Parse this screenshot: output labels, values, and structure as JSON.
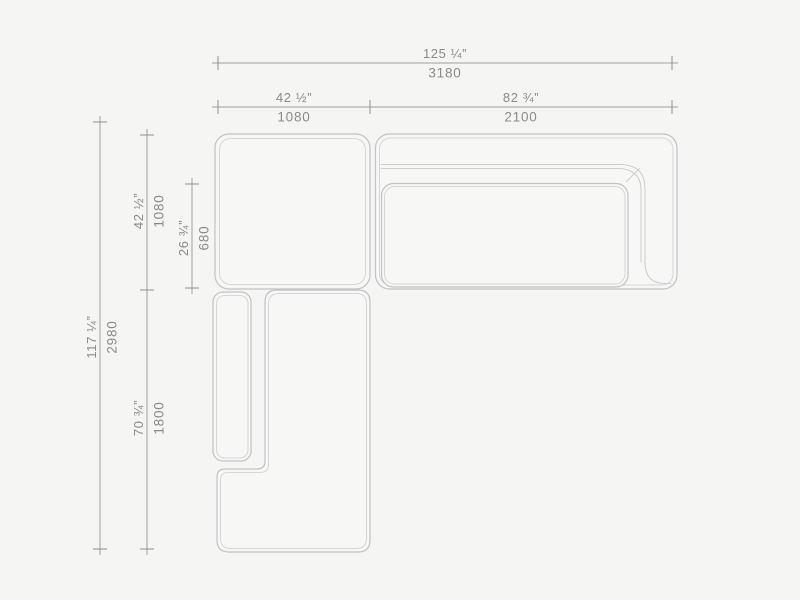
{
  "drawing": {
    "colors": {
      "background": "#f5f5f4",
      "module_fill": "#f7f7f6",
      "module_outline": "#c0c2c4",
      "module_inner_line": "#d5d6d7",
      "dimension_line": "#9e9e9e",
      "dimension_text": "#8a8a8a"
    },
    "dimensions": {
      "overall_width": {
        "inches": "125 ¼”",
        "mm": "3180"
      },
      "corner_width": {
        "inches": "42 ½”",
        "mm": "1080"
      },
      "right_sofa_width": {
        "inches": "82 ¾”",
        "mm": "2100"
      },
      "overall_depth": {
        "inches": "117 ¼”",
        "mm": "2980"
      },
      "corner_depth": {
        "inches": "42 ½”",
        "mm": "1080"
      },
      "seat_depth": {
        "inches": "26 ¾”",
        "mm": "680"
      },
      "chaise_depth": {
        "inches": "70 ¾”",
        "mm": "1800"
      }
    }
  }
}
